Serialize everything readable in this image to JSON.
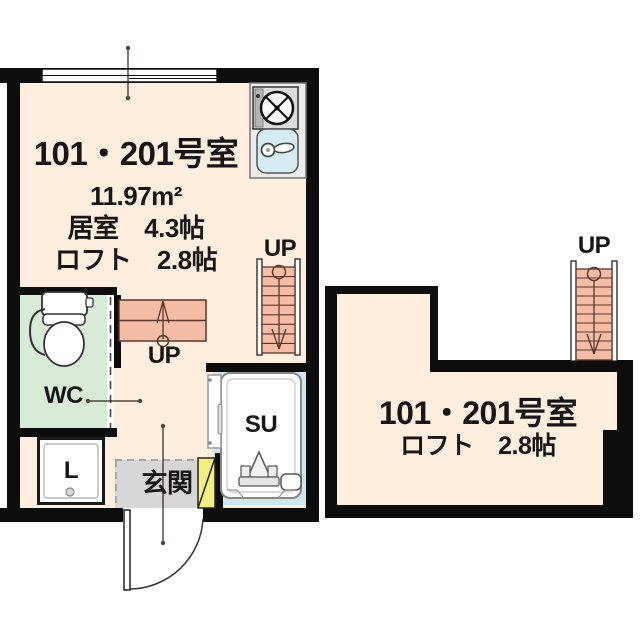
{
  "left_plan": {
    "title": "101・201号室",
    "area": "11.97m²",
    "living_size": "居室　4.3帖",
    "loft_size": "ロフト　2.8帖",
    "wc_label": "WC",
    "shower_label": "SU",
    "entrance_label": "玄関",
    "laundry_label": "L",
    "stairs_lower_up_label": "UP",
    "stairs_upper_up_label": "UP"
  },
  "right_plan": {
    "title": "101・201号室",
    "loft_size": "ロフト　2.8帖",
    "stairs_up_label": "UP"
  },
  "colors": {
    "wall": "#0d0d0d",
    "floor": "#fdeede",
    "wc_floor": "#d7ebd7",
    "entrance_floor": "#d7d7d7",
    "shoe_cabinet": "#f3ef7d",
    "shower_floor": "#cde9ee",
    "sink": "#d5edf2",
    "stairs": "#f5bda5",
    "stairs_line": "#5d352a"
  }
}
